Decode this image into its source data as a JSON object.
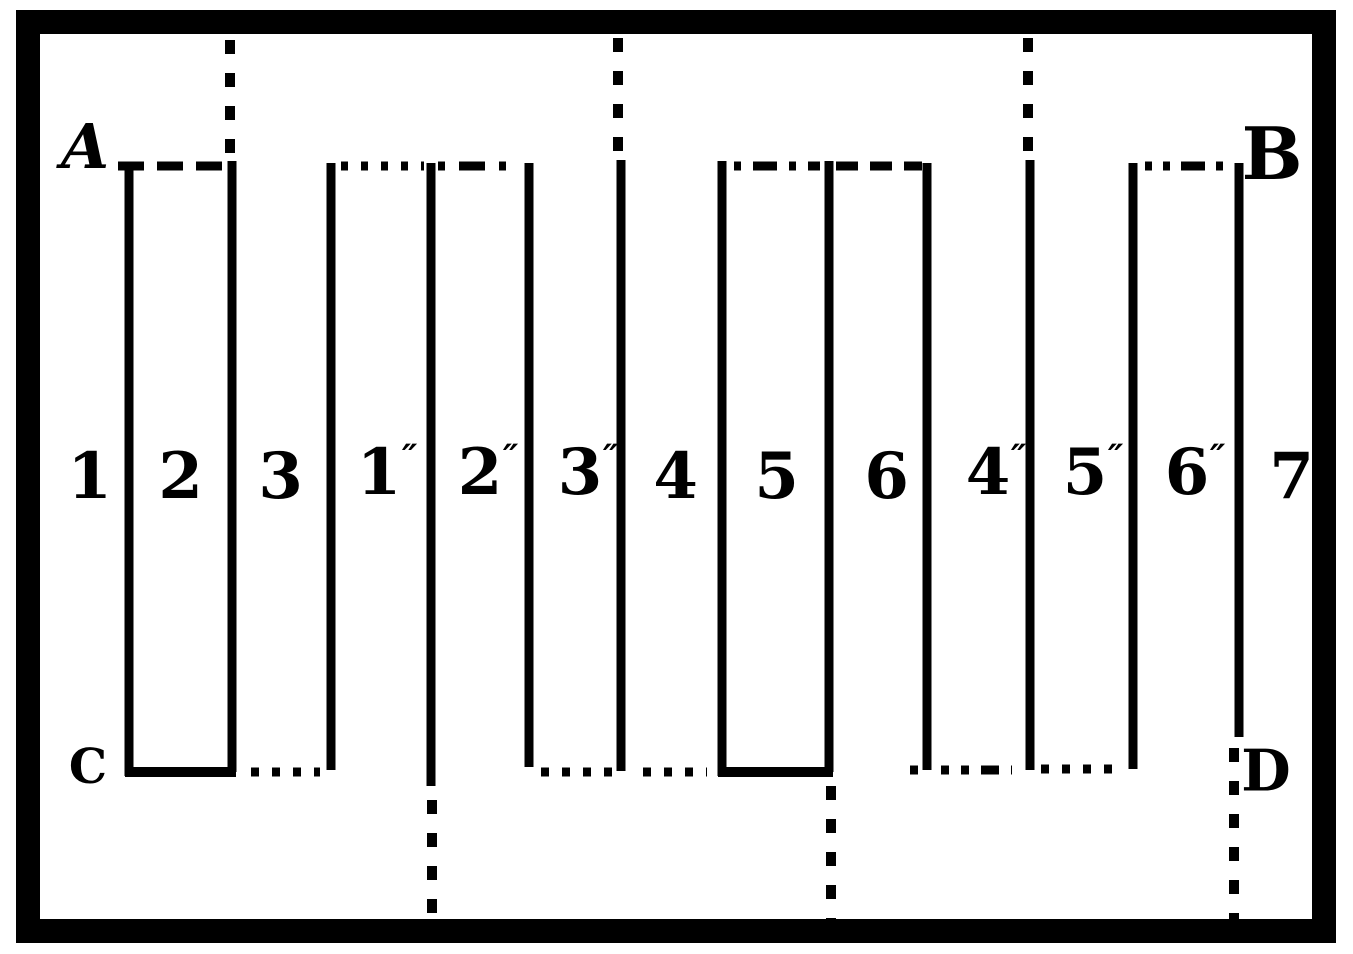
{
  "figure": {
    "corners": {
      "top_left": "A",
      "top_right": "B",
      "bottom_left": "C",
      "bottom_right": "D"
    },
    "panels": [
      {
        "label": "1"
      },
      {
        "label": "2"
      },
      {
        "label": "3"
      },
      {
        "label": "1",
        "prime": "″"
      },
      {
        "label": "2",
        "prime": "″"
      },
      {
        "label": "3",
        "prime": "″"
      },
      {
        "label": "4"
      },
      {
        "label": "5"
      },
      {
        "label": "6"
      },
      {
        "label": "4",
        "prime": "″"
      },
      {
        "label": "5",
        "prime": "″"
      },
      {
        "label": "6",
        "prime": "″"
      },
      {
        "label": "7"
      }
    ],
    "colors": {
      "ink": "#000000",
      "paper": "#ffffff"
    }
  }
}
